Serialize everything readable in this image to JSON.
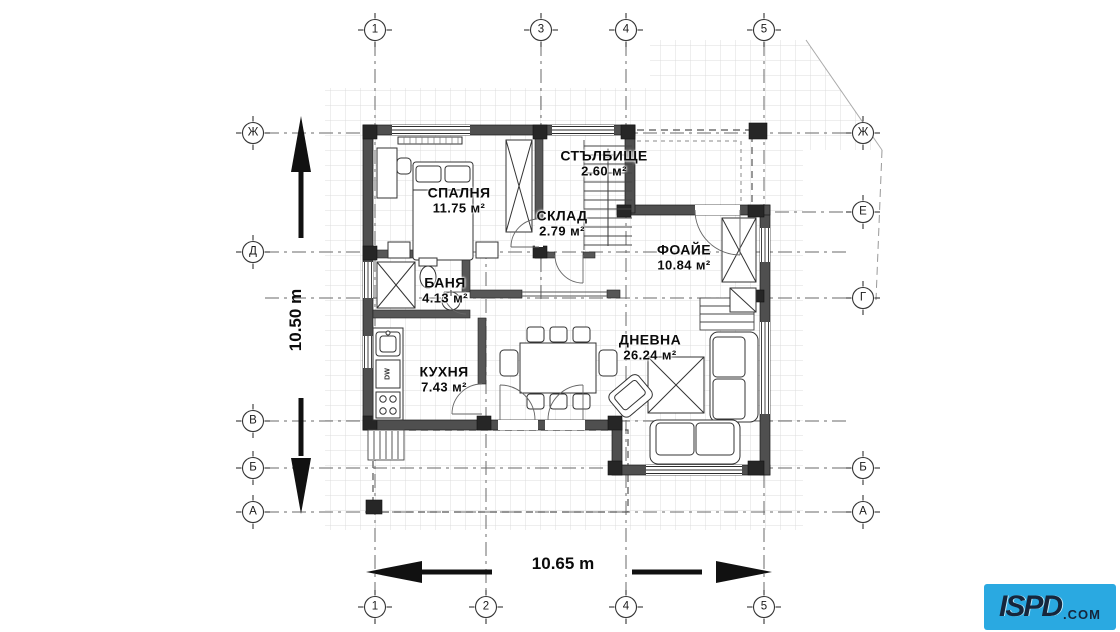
{
  "document": {
    "type": "floor-plan",
    "language": "bg"
  },
  "axes": {
    "top": [
      "1",
      "3",
      "4",
      "5"
    ],
    "bottom": [
      "1",
      "2",
      "4",
      "5"
    ],
    "left": [
      "Ж",
      "Д",
      "В",
      "Б",
      "А"
    ],
    "right": [
      "Ж",
      "Е",
      "Г",
      "Б",
      "А"
    ]
  },
  "rooms": [
    {
      "name": "СПАЛНЯ",
      "area": "11.75 м²"
    },
    {
      "name": "СТЪЛБИЩЕ",
      "area": "2.60 м²"
    },
    {
      "name": "СКЛАД",
      "area": "2.79 м²"
    },
    {
      "name": "ФОАЙЕ",
      "area": "10.84 м²"
    },
    {
      "name": "БАНЯ",
      "area": "4.13 м²"
    },
    {
      "name": "КУХНЯ",
      "area": "7.43 м²"
    },
    {
      "name": "ДНЕВНА",
      "area": "26.24 м²"
    }
  ],
  "dimensions": {
    "vertical": "10.50 m",
    "horizontal": "10.65 m"
  },
  "labels": {
    "dishwasher": "DW"
  },
  "logo": {
    "name": "ISPD",
    "tld": ".COM",
    "bg": "#2aa9e1",
    "fg": "#16263c"
  },
  "colors": {
    "wall": "#4f4f4f",
    "grid": "#d9d9d9",
    "axis": "#666666",
    "dimension": "#111111"
  }
}
